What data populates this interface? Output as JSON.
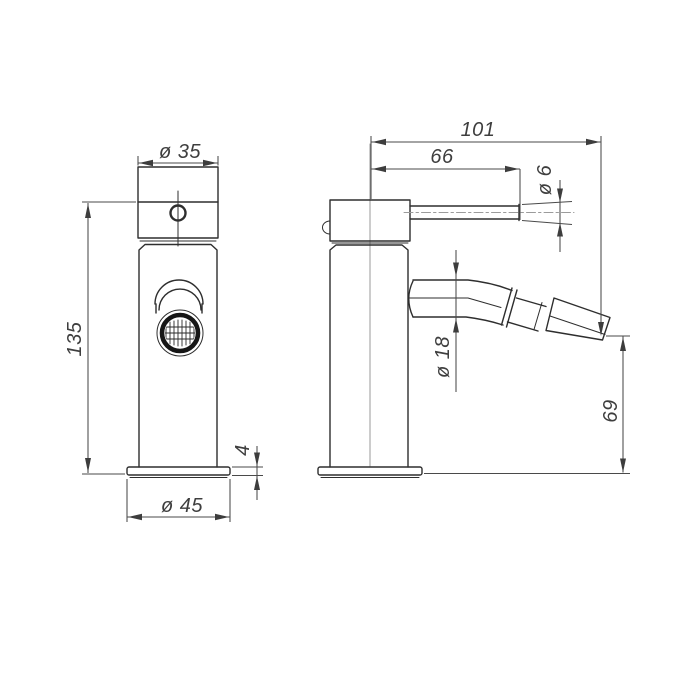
{
  "drawing": {
    "front_view": {
      "head_diameter": "ø 35",
      "total_height": "135",
      "base_thickness": "4",
      "base_diameter": "ø 45"
    },
    "side_view": {
      "total_depth": "101",
      "lever_reach": "66",
      "lever_diameter": "ø 6",
      "spout_diameter": "ø 18",
      "spout_tip_height": "69"
    }
  }
}
